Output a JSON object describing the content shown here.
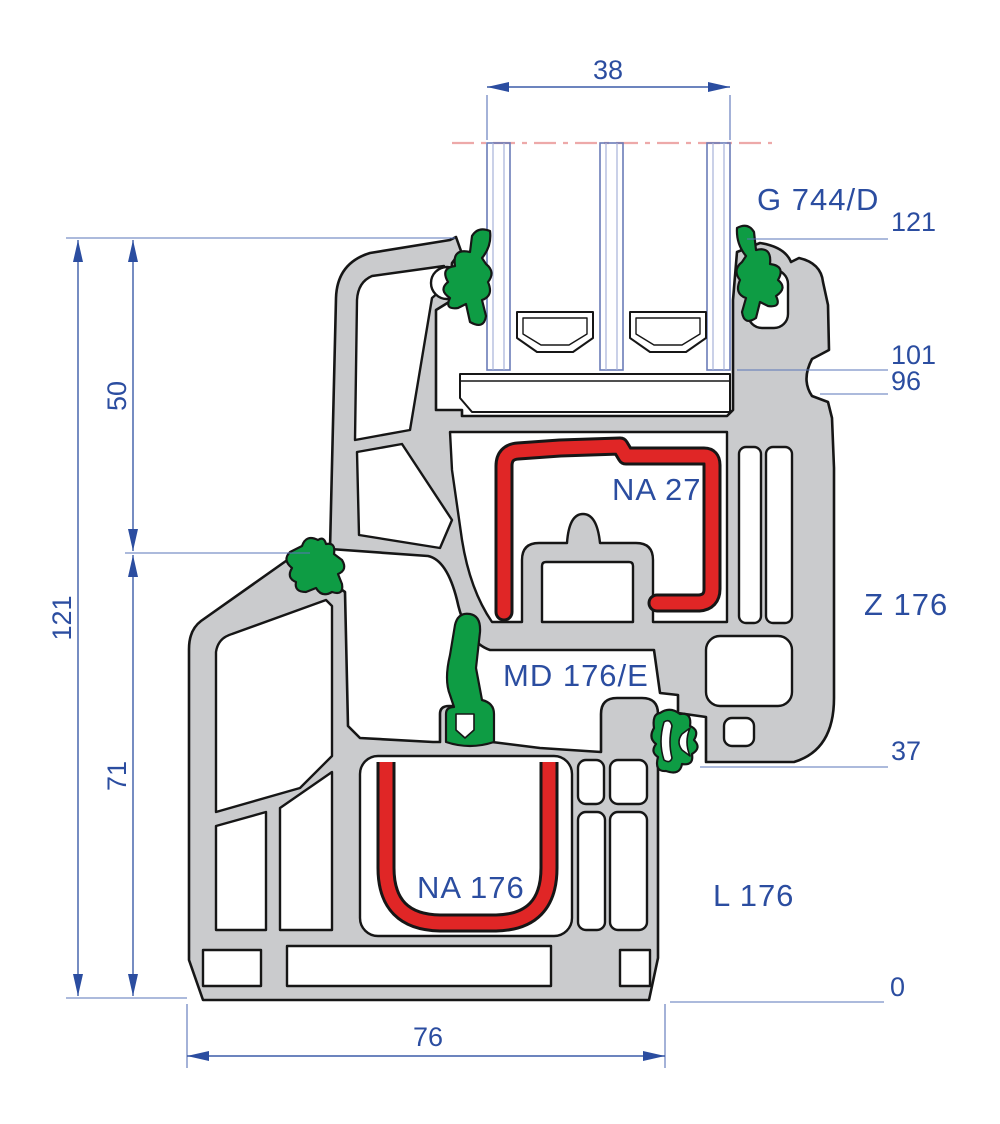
{
  "drawing": {
    "title": "window-profile-cross-section",
    "profile_labels": {
      "glazing": "G 744/D",
      "sash_gasket": "NA 27",
      "sash": "Z 176",
      "mid_seal": "MD 176/E",
      "frame_gasket": "NA 176",
      "frame": "L 176"
    },
    "dimensions": {
      "glass_width": "38",
      "overall_height": "121",
      "upper_height": "50",
      "lower_height": "71",
      "frame_width": "76"
    },
    "level_marks": {
      "top": "121",
      "glass_seat": "101",
      "notch": "96",
      "sash_bottom": "37",
      "base": "0"
    },
    "colors": {
      "dimension_blue": "#2b4da0",
      "profile_gray": "#cacbcd",
      "gasket_red": "#e02626",
      "gasket_green": "#0e9c44",
      "outline_black": "#161616",
      "centerline_pink": "#eda9a9"
    }
  }
}
